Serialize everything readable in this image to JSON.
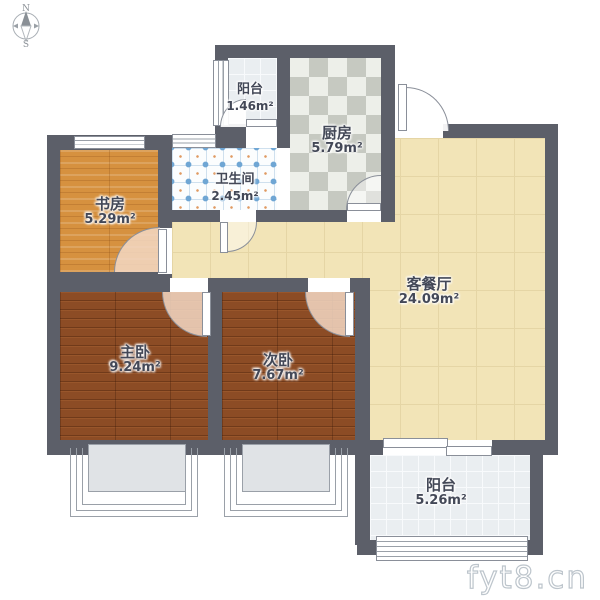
{
  "compass": {
    "north_label": "N",
    "south_label": "S"
  },
  "rooms": {
    "balcony_top": {
      "name": "阳台",
      "area": "1.46m²"
    },
    "kitchen": {
      "name": "厨房",
      "area": "5.79m²"
    },
    "study": {
      "name": "书房",
      "area": "5.29m²"
    },
    "bathroom": {
      "name": "卫生间",
      "area": "2.45m²"
    },
    "living_dining": {
      "name": "客餐厅",
      "area": "24.09m²"
    },
    "master_bedroom": {
      "name": "主卧",
      "area": "9.24m²"
    },
    "second_bedroom": {
      "name": "次卧",
      "area": "7.67m²"
    },
    "balcony_bottom": {
      "name": "阳台",
      "area": "5.26m²"
    }
  },
  "watermark": {
    "text": "fyt8.cn"
  },
  "colors": {
    "wall": "#5c5f69",
    "living_floor": "#f2e4b7",
    "study_floor": "#d6913f",
    "bedroom_floor": "#8c4c25",
    "kitchen_tile": "#c6c9c1",
    "bathroom_accent": "#6fa6d4",
    "balcony_floor": "#eaeef1",
    "door_arc": "#f3d8c4"
  }
}
